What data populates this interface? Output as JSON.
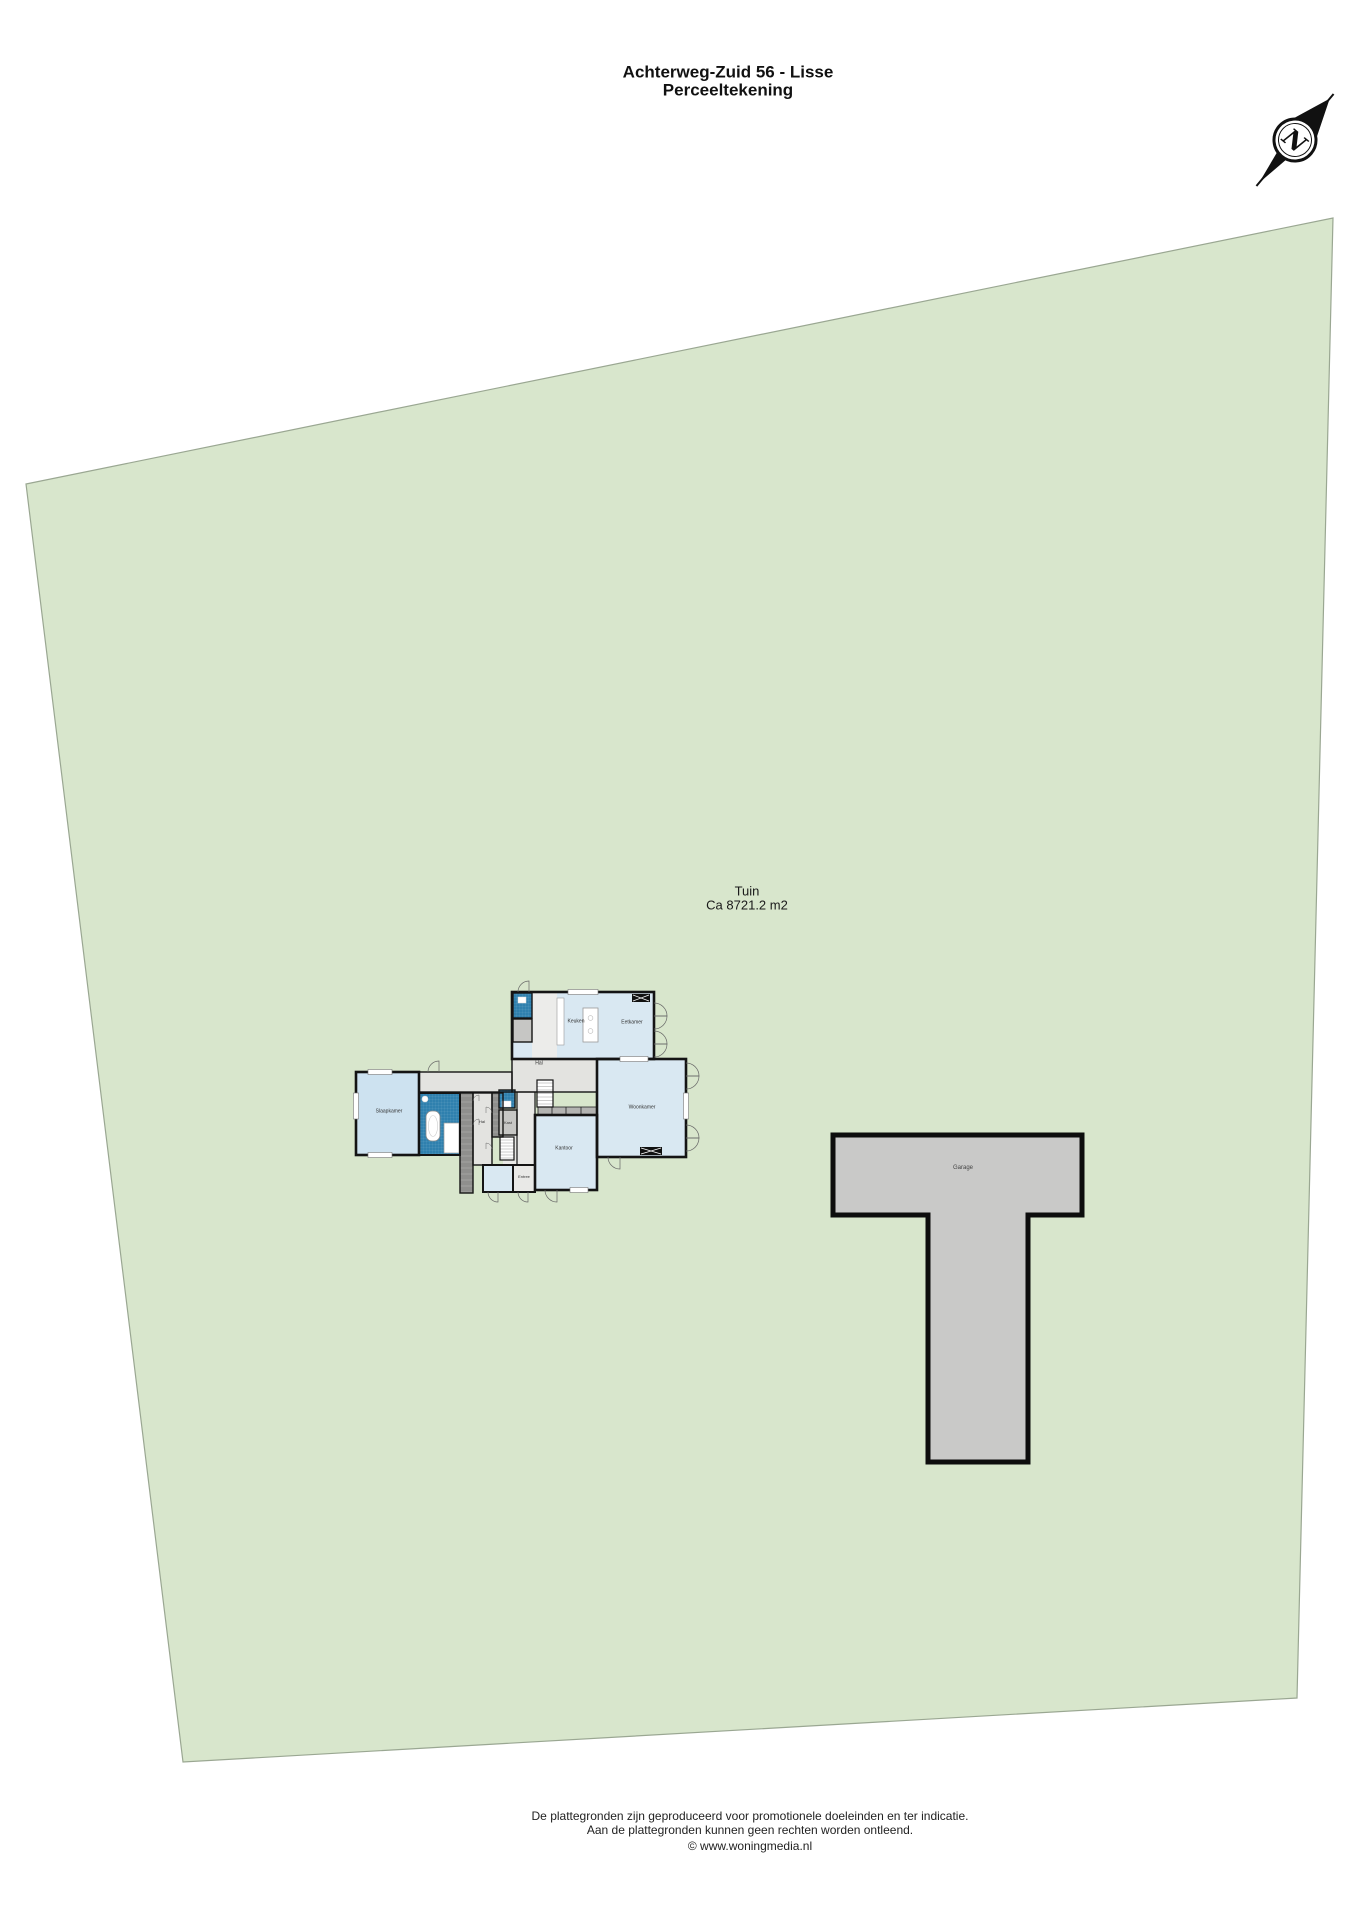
{
  "header": {
    "title": "Achterweg-Zuid 56 - Lisse",
    "subtitle": "Perceeltekening"
  },
  "compass": {
    "north_label": "N"
  },
  "garden": {
    "name": "Tuin",
    "area": "Ca 8721.2 m2"
  },
  "outbuilding": {
    "label": "Garage"
  },
  "floorplan": {
    "labels": {
      "kitchen": "Keuken",
      "dining": "Eetkamer",
      "hall_top": "Hal",
      "living": "Woonkamer",
      "office": "Kantoor",
      "bedroom": "Slaapkamer",
      "hall_left": "Hal",
      "closet": "Kast",
      "entry": "Entree"
    }
  },
  "footer": {
    "disclaimer1": "De plattegronden zijn geproduceerd voor promotionele doeleinden en ter indicatie.",
    "disclaimer2": "Aan de plattegronden kunnen geen rechten worden ontleend.",
    "copyright": "© www.woningmedia.nl"
  },
  "colors": {
    "plot_green": "#d8e6cc",
    "plot_border": "#9aa792",
    "room_light_blue": "#d9e8f2",
    "room_dark_blue": "#2f80ae",
    "corridor_gray": "#e3e3e0",
    "wardrobe_gray": "#8f8f8d",
    "outbuilding_gray": "#c9c9c8",
    "wall_black": "#141414"
  }
}
